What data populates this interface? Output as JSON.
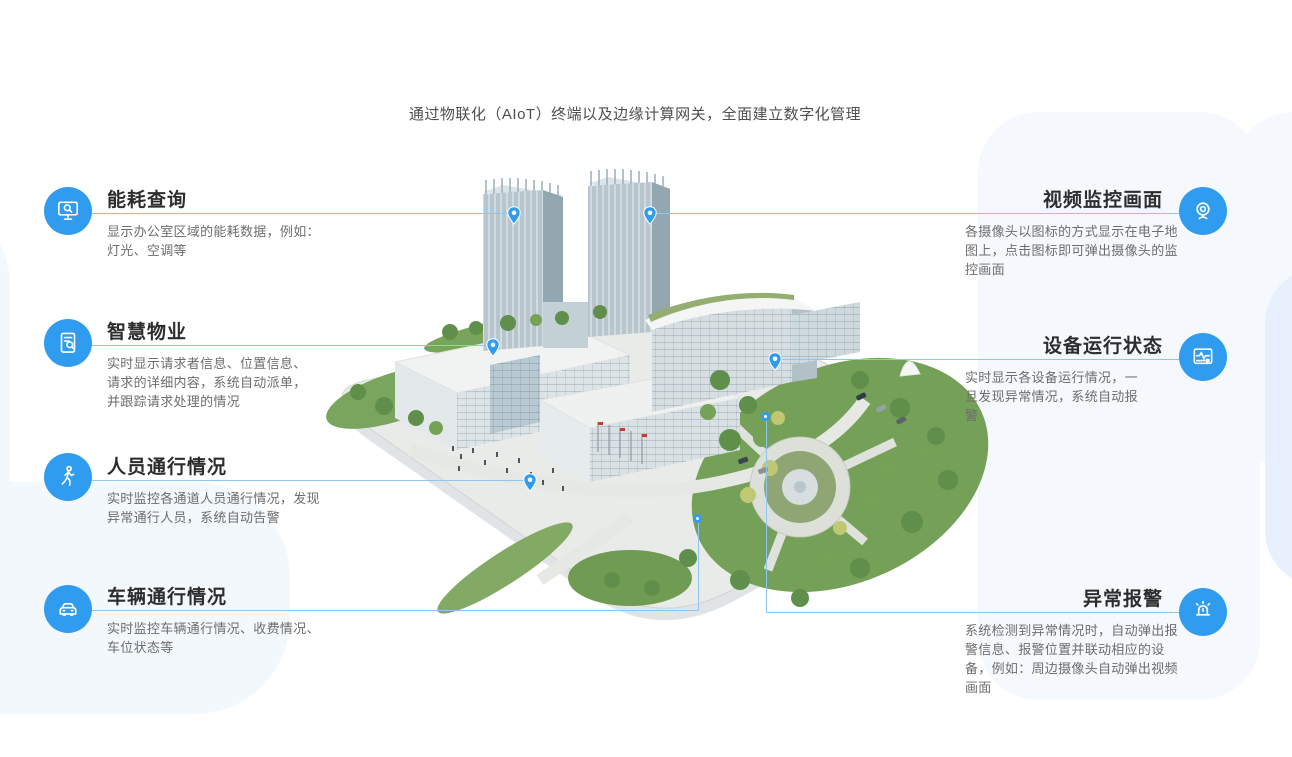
{
  "page": {
    "heading": "通过物联化（AIoT）终端以及边缘计算网关，全面建立数字化管理"
  },
  "colors": {
    "accent_blue": "#2f9cf0",
    "connector_line": "#8ec6f3",
    "title_text": "#2d2d2d",
    "body_text": "#6d6d6d",
    "bg_tint_light": "#f5f9fd",
    "bg_tint_dark": "#e7f0fc"
  },
  "features_left": [
    {
      "title": "能耗查询",
      "desc": "显示办公室区域的能耗数据，例如：\n灯光、空调等",
      "icon": "monitor-search-icon"
    },
    {
      "title": "智慧物业",
      "desc": "实时显示请求者信息、位置信息、\n请求的详细内容，系统自动派单，\n并跟踪请求处理的情况",
      "icon": "document-search-icon"
    },
    {
      "title": "人员通行情况",
      "desc": "实时监控各通道人员通行情况，发现\n异常通行人员，系统自动告警",
      "icon": "pedestrian-icon"
    },
    {
      "title": "车辆通行情况",
      "desc": "实时监控车辆通行情况、收费情况、\n车位状态等",
      "icon": "car-icon"
    }
  ],
  "features_right": [
    {
      "title": "视频监控画面",
      "desc": "各摄像头以图标的方式显示在电子地\n图上，点击图标即可弹出摄像头的监\n控画面",
      "icon": "webcam-icon"
    },
    {
      "title": "设备运行状态",
      "desc": "实时显示各设备运行情况，一\n旦发现异常情况，系统自动报\n警",
      "icon": "device-status-icon"
    },
    {
      "title": "异常报警",
      "desc": "系统检测到异常情况时，自动弹出报\n警信息、报警位置并联动相应的设\n备，例如：周边摄像头自动弹出视频\n画面",
      "icon": "alarm-icon"
    }
  ]
}
